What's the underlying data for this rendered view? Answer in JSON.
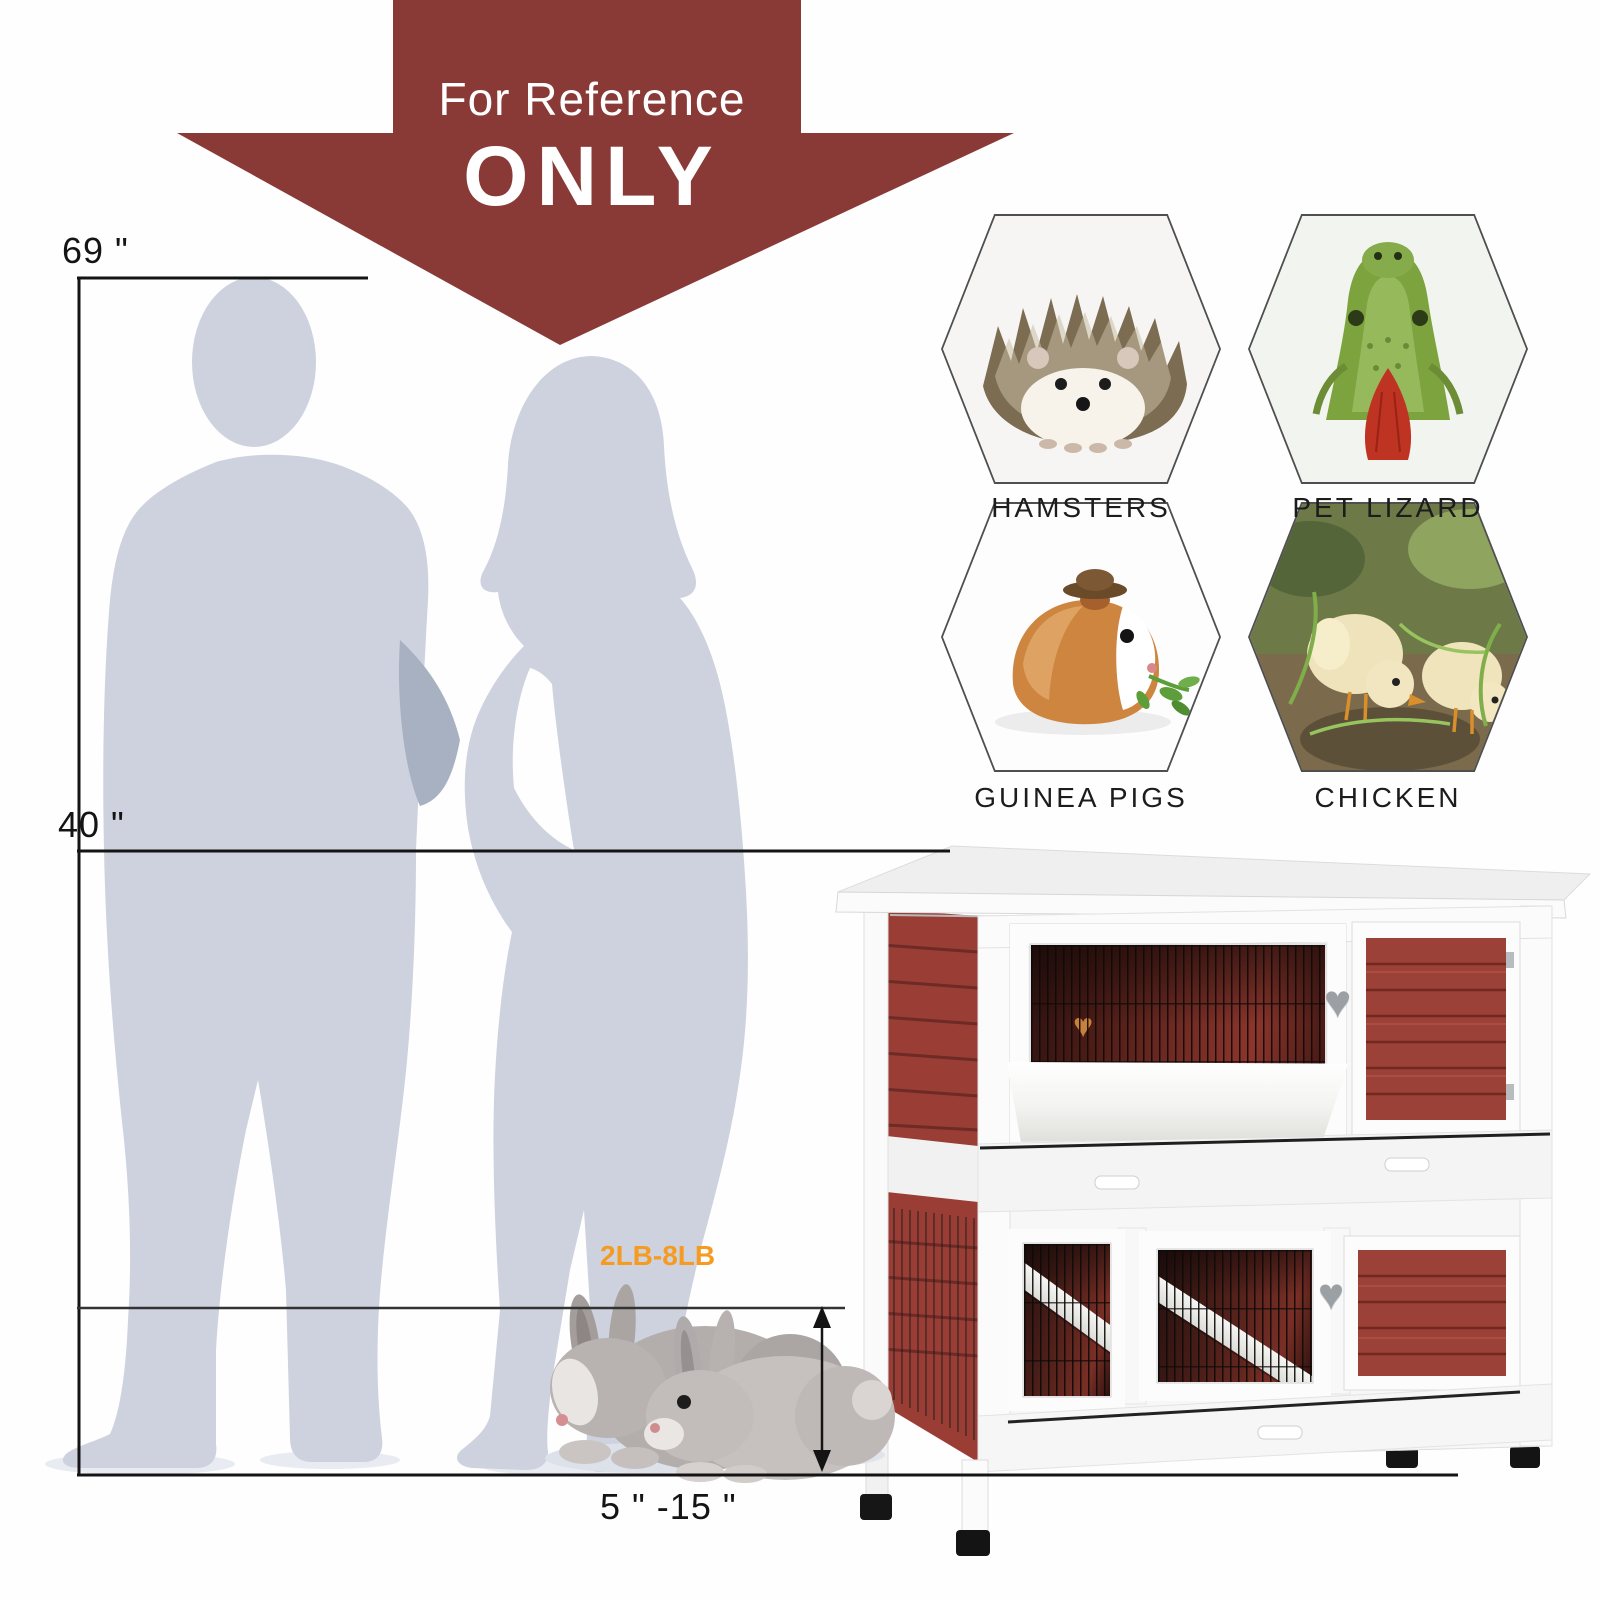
{
  "banner": {
    "line1": "For Reference",
    "line2": "ONLY",
    "background_color": "#8a3a36",
    "text_color": "#ffffff"
  },
  "measurements": {
    "person_height": "69 \"",
    "hutch_height": "40 \"",
    "rabbit_height_range": "5 \" -15 \"",
    "rabbit_weight_range": "2LB-8LB",
    "weight_label_color": "#f59b20",
    "line_color": "#141414"
  },
  "suitable_pets": [
    {
      "label": "HAMSTERS",
      "image": "hedgehog-photo"
    },
    {
      "label": "PET LIZARD",
      "image": "lizard-photo"
    },
    {
      "label": "GUINEA PIGS",
      "image": "guinea-pig-photo"
    },
    {
      "label": "CHICKEN",
      "image": "chicks-photo"
    }
  ],
  "icons": {
    "heart_handle": "♥",
    "heart_decor": "♥"
  },
  "illustrations": {
    "people": "man-and-woman-silhouettes",
    "animal": "two-grey-rabbits",
    "product": "two-story-red-white-rabbit-hutch"
  },
  "colors": {
    "silhouette_gray": "#cdd2de",
    "hutch_red": "#9c4138",
    "hutch_white": "#fbfbfb",
    "accent_orange": "#f59b20"
  }
}
